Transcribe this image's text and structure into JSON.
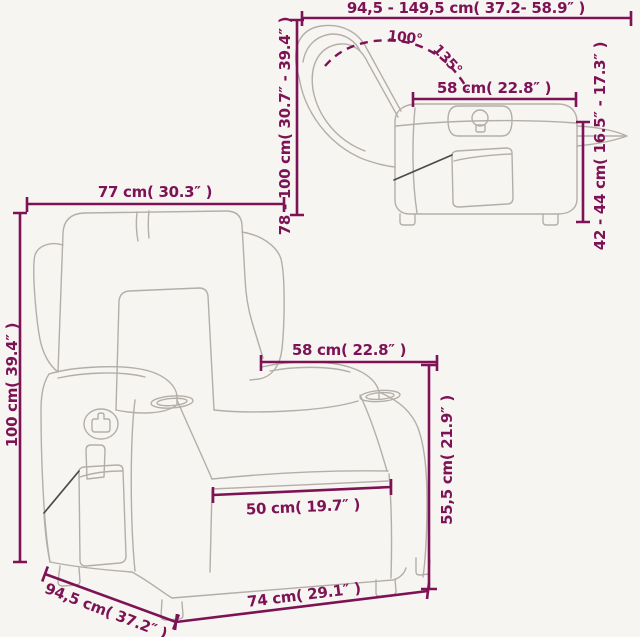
{
  "diagram": {
    "type": "product-dimensions",
    "subject": "recliner chair technical line drawing (front view and reclined side view)",
    "colors": {
      "background": "#f6f5f1",
      "dimension_accent": "#7d1255",
      "chair_outline": "#b4aea8",
      "callout_line": "#4d4a47"
    },
    "side_view": {
      "dimensions": {
        "width_range": "94,5 - 149,5 cm( 37.2- 58.9″ )",
        "height_range": "78 - 100 cm( 30.7″ - 39.4″ )",
        "backrest_depth": "58 cm( 22.8″ )",
        "seat_height_range": "42 - 44 cm( 16.5″ - 17.3″ )",
        "recline_angle_min": "100°",
        "recline_angle_max": "135°"
      }
    },
    "front_view": {
      "dimensions": {
        "width": "77 cm( 30.3″ )",
        "height": "100 cm( 39.4″ )",
        "armrest_span": "58 cm( 22.8″ )",
        "seat_back_height": "55,5 cm( 21.9″ )",
        "seat_width": "50 cm( 19.7″ )",
        "depth": "94,5 cm( 37.2″ )",
        "base_width": "74 cm( 29.1″ )"
      }
    }
  }
}
